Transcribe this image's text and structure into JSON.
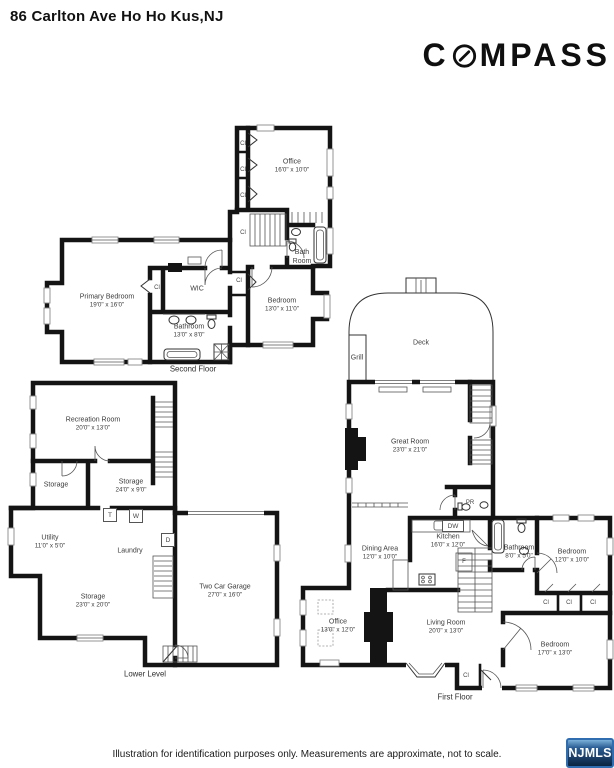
{
  "header": {
    "title": "86 Carlton Ave Ho Ho Kus,NJ",
    "brand_prefix": "C",
    "brand_suffix": "MPASS"
  },
  "markers": {
    "closet": "Cl",
    "powder_room": "PR",
    "washer": "W",
    "dryer": "D",
    "tank": "T",
    "dishwasher": "DW",
    "fridge": "F"
  },
  "floors": {
    "second": {
      "caption": "Second Floor",
      "rooms": {
        "office": {
          "name": "Office",
          "dims": "16'0\" x 10'0\""
        },
        "bath_room": {
          "name": "Bath Room"
        },
        "primary_bedroom": {
          "name": "Primary Bedroom",
          "dims": "19'0\" x 16'0\""
        },
        "wic": {
          "name": "WIC"
        },
        "bedroom": {
          "name": "Bedroom",
          "dims": "13'0\" x 11'0\""
        },
        "bathroom": {
          "name": "Bathroom",
          "dims": "13'0\" x 8'0\""
        }
      }
    },
    "lower": {
      "caption": "Lower Level",
      "rooms": {
        "recreation_room": {
          "name": "Recreation Room",
          "dims": "20'0\" x 13'0\""
        },
        "storage_small": {
          "name": "Storage"
        },
        "storage_mid": {
          "name": "Storage",
          "dims": "24'0\" x 9'0\""
        },
        "utility": {
          "name": "Utility",
          "dims": "11'0\" x 5'0\""
        },
        "laundry": {
          "name": "Laundry"
        },
        "storage_large": {
          "name": "Storage",
          "dims": "23'0\" x 20'0\""
        },
        "garage": {
          "name": "Two Car Garage",
          "dims": "27'0\" x 16'0\""
        }
      }
    },
    "first": {
      "caption": "First Floor",
      "rooms": {
        "deck": {
          "name": "Deck"
        },
        "grill": {
          "name": "Grill"
        },
        "great_room": {
          "name": "Great Room",
          "dims": "23'0\" x 21'0\""
        },
        "kitchen": {
          "name": "Kitchen",
          "dims": "16'0\" x 12'0\""
        },
        "dining_area": {
          "name": "Dining Area",
          "dims": "12'0\" x 10'0\""
        },
        "bathroom": {
          "name": "Bathroom",
          "dims": "8'0\" x 5'0\""
        },
        "bedroom_small": {
          "name": "Bedroom",
          "dims": "12'0\" x 10'0\""
        },
        "office": {
          "name": "Office",
          "dims": "13'0\" x 12'0\""
        },
        "living_room": {
          "name": "Living Room",
          "dims": "20'0\" x 13'0\""
        },
        "bedroom_large": {
          "name": "Bedroom",
          "dims": "17'0\" x 13'0\""
        }
      }
    }
  },
  "footer": {
    "disclaimer": "Illustration for identification purposes only. Measurements are approximate, not to scale.",
    "mls_logo": "NJMLS"
  }
}
